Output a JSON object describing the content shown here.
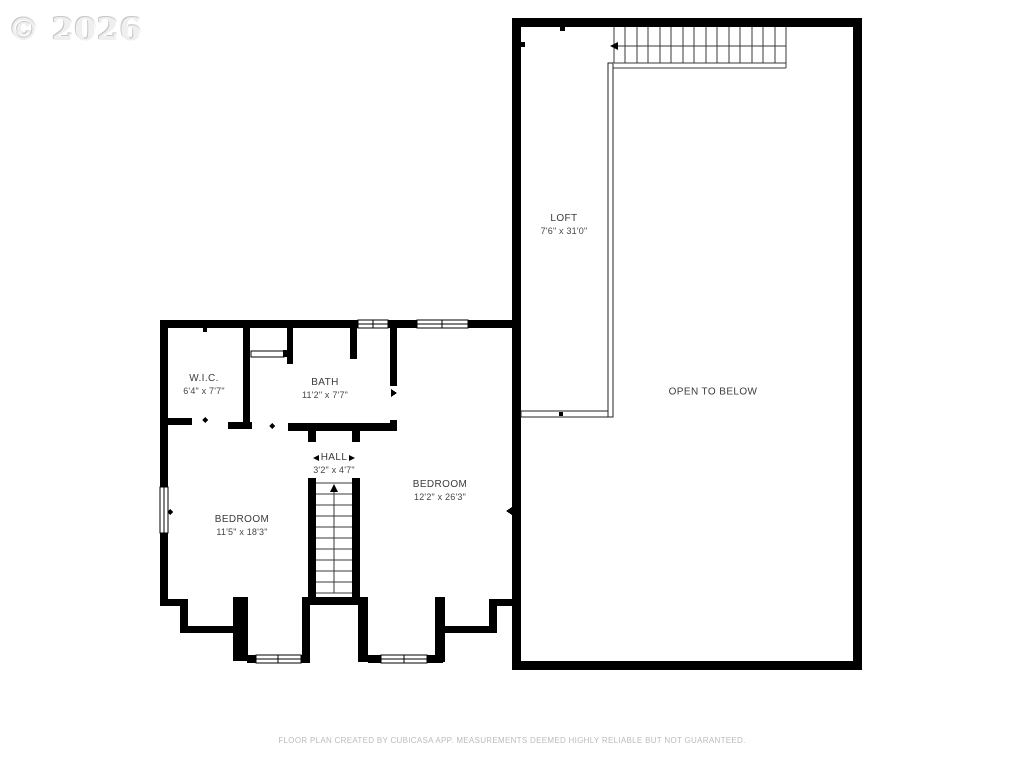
{
  "watermark": "© 2026",
  "rooms": {
    "loft": {
      "name": "LOFT",
      "dims": "7'6\" x 31'0\""
    },
    "open_to_below": {
      "name": "OPEN TO BELOW",
      "dims": ""
    },
    "wic": {
      "name": "W.I.C.",
      "dims": "6'4\" x 7'7\""
    },
    "bath": {
      "name": "BATH",
      "dims": "11'2\" x 7'7\""
    },
    "hall": {
      "name": "HALL",
      "dims": "3'2\" x 4'7\""
    },
    "bedroom_left": {
      "name": "BEDROOM",
      "dims": "11'5\" x 18'3\""
    },
    "bedroom_right": {
      "name": "BEDROOM",
      "dims": "12'2\" x 26'3\""
    }
  },
  "footer": "FLOOR PLAN CREATED BY CUBICASA APP. MEASUREMENTS DEEMED HIGHLY RELIABLE BUT NOT GUARANTEED.",
  "colors": {
    "wall": "#000000",
    "label": "#3b3b3b",
    "stair_line": "#3a3a3a",
    "footer": "#bcbcbc",
    "watermark": "#efefef"
  }
}
